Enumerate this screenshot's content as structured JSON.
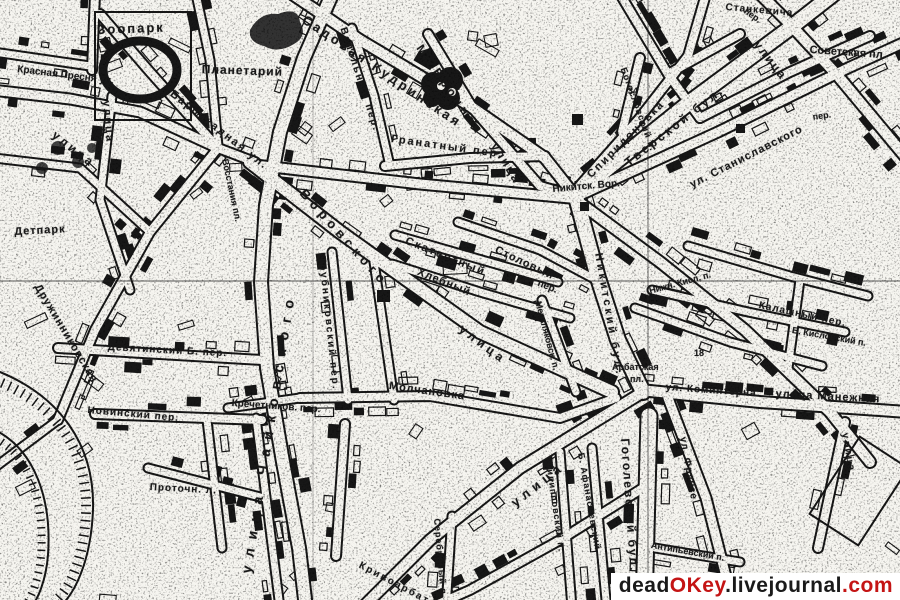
{
  "map": {
    "ink": "#171717",
    "paper": "#f6f5f0",
    "grid_color": "#222222",
    "labels": [
      {
        "t": "Зоопарк",
        "x": 97,
        "y": 22,
        "r": -2,
        "s": 13,
        "ls": 2
      },
      {
        "t": "Планетарий",
        "x": 202,
        "y": 62,
        "r": 2,
        "s": 12,
        "ls": 1
      },
      {
        "t": "Красная Пресня ул.",
        "x": 18,
        "y": 64,
        "r": 7,
        "s": 10,
        "ls": 0
      },
      {
        "t": "улица",
        "x": 58,
        "y": 128,
        "r": 38,
        "s": 12,
        "ls": 3
      },
      {
        "t": "улица",
        "x": 112,
        "y": 100,
        "r": 85,
        "s": 11,
        "ls": 2
      },
      {
        "t": "Баррикадная ул.",
        "x": 175,
        "y": 88,
        "r": 38,
        "s": 11,
        "ls": 2
      },
      {
        "t": "Восстания пл.",
        "x": 230,
        "y": 158,
        "r": 78,
        "s": 9,
        "ls": 0
      },
      {
        "t": "Садовая-Кудринская",
        "x": 308,
        "y": 12,
        "r": 34,
        "s": 13,
        "ls": 3
      },
      {
        "t": "М. Бронная",
        "x": 425,
        "y": 42,
        "r": 55,
        "s": 12,
        "ls": 4
      },
      {
        "t": "улица",
        "x": 500,
        "y": 140,
        "r": 58,
        "s": 12,
        "ls": 2
      },
      {
        "t": "Спиридоновка",
        "x": 585,
        "y": 172,
        "r": -45,
        "s": 11,
        "ls": 2
      },
      {
        "t": "Гранатный пер.",
        "x": 392,
        "y": 133,
        "r": 8,
        "s": 11,
        "ls": 2
      },
      {
        "t": "Вспольный пер.",
        "x": 348,
        "y": 26,
        "r": 72,
        "s": 10,
        "ls": 2
      },
      {
        "t": "Богословский п.",
        "x": 628,
        "y": 66,
        "r": 70,
        "s": 9,
        "ls": 1
      },
      {
        "t": "Тверской бул.",
        "x": 622,
        "y": 158,
        "r": -38,
        "s": 12,
        "ls": 3
      },
      {
        "t": "улица",
        "x": 762,
        "y": 38,
        "r": 52,
        "s": 12,
        "ls": 2
      },
      {
        "t": "Советская пл.",
        "x": 810,
        "y": 44,
        "r": 4,
        "s": 11,
        "ls": 0
      },
      {
        "t": "ул. Станиславского",
        "x": 688,
        "y": 180,
        "r": -27,
        "s": 11,
        "ls": 1
      },
      {
        "t": "Никитск. Вор.",
        "x": 552,
        "y": 184,
        "r": -5,
        "s": 10,
        "ls": 0
      },
      {
        "t": "Станкевича",
        "x": 726,
        "y": 2,
        "r": 5,
        "s": 10,
        "ls": 1
      },
      {
        "t": "пер.",
        "x": 812,
        "y": 112,
        "r": -8,
        "s": 9,
        "ls": 0
      },
      {
        "t": "пер.",
        "x": 748,
        "y": 6,
        "r": 35,
        "s": 9,
        "ls": 0
      },
      {
        "t": "Никитский бул.",
        "x": 604,
        "y": 252,
        "r": 80,
        "s": 11,
        "ls": 3
      },
      {
        "t": "Нижн. Кисл. п.",
        "x": 648,
        "y": 286,
        "r": -15,
        "s": 9,
        "ls": 0
      },
      {
        "t": "Калашный пер.",
        "x": 760,
        "y": 300,
        "r": 12,
        "s": 10,
        "ls": 1
      },
      {
        "t": "Б. Кисловский п.",
        "x": 793,
        "y": 325,
        "r": 10,
        "s": 9,
        "ls": 0
      },
      {
        "t": "Арбатская",
        "x": 612,
        "y": 362,
        "r": 0,
        "s": 9,
        "ls": 0
      },
      {
        "t": "пл.",
        "x": 630,
        "y": 374,
        "r": 0,
        "s": 9,
        "ls": 0
      },
      {
        "t": "ул. Коминтерна",
        "x": 666,
        "y": 382,
        "r": 4,
        "s": 10,
        "ls": 1
      },
      {
        "t": "улица Манежная",
        "x": 776,
        "y": 388,
        "r": 3,
        "s": 11,
        "ls": 1
      },
      {
        "t": "ул. Фрунзе",
        "x": 688,
        "y": 436,
        "r": 80,
        "s": 10,
        "ls": 1
      },
      {
        "t": "Гоголевский бул.",
        "x": 632,
        "y": 438,
        "r": 86,
        "s": 12,
        "ls": 2
      },
      {
        "t": "Антипьевский п.",
        "x": 652,
        "y": 540,
        "r": 10,
        "s": 9,
        "ls": 0
      },
      {
        "t": "улица",
        "x": 508,
        "y": 498,
        "r": -38,
        "s": 13,
        "ls": 5
      },
      {
        "t": "улица",
        "x": 850,
        "y": 432,
        "r": 80,
        "s": 10,
        "ls": 2
      },
      {
        "t": "Серебряный п.",
        "x": 442,
        "y": 518,
        "r": 85,
        "s": 9,
        "ls": 1
      },
      {
        "t": "Филипповский п.",
        "x": 554,
        "y": 460,
        "r": 82,
        "s": 9,
        "ls": 1
      },
      {
        "t": "Б. Афанасьевский",
        "x": 586,
        "y": 452,
        "r": 80,
        "s": 9,
        "ls": 1
      },
      {
        "t": "Кривоарбатский",
        "x": 362,
        "y": 560,
        "r": 28,
        "s": 10,
        "ls": 2
      },
      {
        "t": "улица Чайковского",
        "x": 238,
        "y": 572,
        "r": -81,
        "s": 14,
        "ls": 9
      },
      {
        "t": "Новинский пер.",
        "x": 88,
        "y": 405,
        "r": 5,
        "s": 10,
        "ls": 1
      },
      {
        "t": "Проточн. л.",
        "x": 150,
        "y": 482,
        "r": 3,
        "s": 10,
        "ls": 1
      },
      {
        "t": "Дружинниковская",
        "x": 42,
        "y": 282,
        "r": 59,
        "s": 11,
        "ls": 1
      },
      {
        "t": "Детпарк",
        "x": 14,
        "y": 226,
        "r": -3,
        "s": 11,
        "ls": 1
      },
      {
        "t": "Трубниковский пер.",
        "x": 327,
        "y": 256,
        "r": 84,
        "s": 10,
        "ls": 2
      },
      {
        "t": "Кречетников. пер.",
        "x": 232,
        "y": 398,
        "r": 4,
        "s": 10,
        "ls": 0
      },
      {
        "t": "Молчановка",
        "x": 390,
        "y": 380,
        "r": 8,
        "s": 11,
        "ls": 1
      },
      {
        "t": "Девятинский Б. пер.",
        "x": 108,
        "y": 342,
        "r": 3,
        "s": 10,
        "ls": 1
      },
      {
        "t": "Воровского",
        "x": 308,
        "y": 186,
        "r": 48,
        "s": 13,
        "ls": 5
      },
      {
        "t": "улица",
        "x": 465,
        "y": 322,
        "r": 37,
        "s": 12,
        "ls": 4
      },
      {
        "t": "Скатертный",
        "x": 408,
        "y": 235,
        "r": 22,
        "s": 11,
        "ls": 2
      },
      {
        "t": "пер.",
        "x": 540,
        "y": 278,
        "r": 22,
        "s": 10,
        "ls": 0
      },
      {
        "t": "Хлебный",
        "x": 420,
        "y": 266,
        "r": 22,
        "s": 11,
        "ls": 1
      },
      {
        "t": "Столовый",
        "x": 498,
        "y": 244,
        "r": 25,
        "s": 11,
        "ls": 1
      },
      {
        "t": "Мерзляковск. п.",
        "x": 543,
        "y": 300,
        "r": 75,
        "s": 9,
        "ls": 0
      },
      {
        "t": "7",
        "x": 100,
        "y": 128,
        "r": 0,
        "s": 10,
        "ls": 0
      },
      {
        "t": "18",
        "x": 694,
        "y": 348,
        "r": 0,
        "s": 9,
        "ls": 0
      },
      {
        "t": "34",
        "x": 628,
        "y": 86,
        "r": 0,
        "s": 9,
        "ls": 0
      }
    ]
  },
  "watermark": {
    "segments": [
      {
        "text": "dead",
        "color": "#1a1a1a"
      },
      {
        "text": "OKey",
        "color": "#c41414"
      },
      {
        "text": ".livejournal",
        "color": "#1a1a1a"
      },
      {
        "text": ".com",
        "color": "#c41414"
      }
    ]
  }
}
